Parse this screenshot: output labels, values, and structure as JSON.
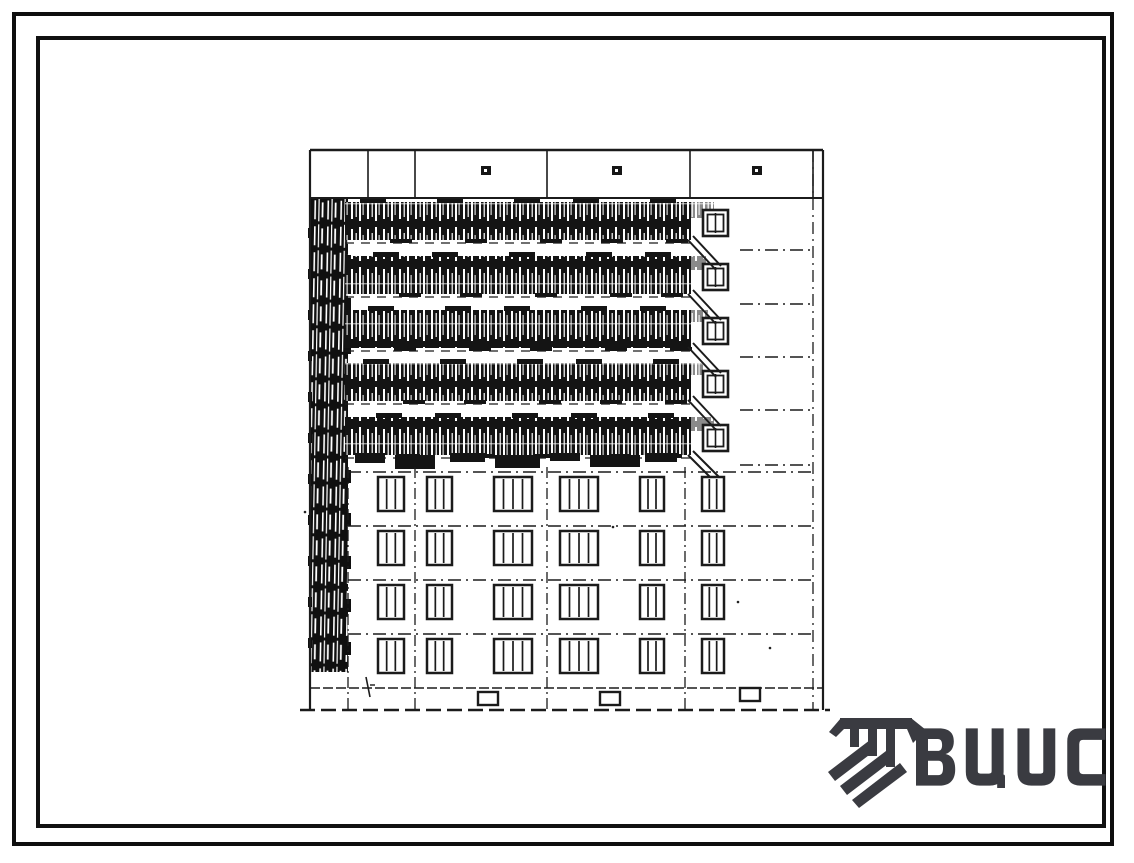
{
  "document": {
    "description": "Scanned facade elevation of a 9-storey panel apartment block: five upper floors with dark hatched balcony bands, four lower floors with window grid, parapet band and basement"
  },
  "branding": {
    "logo_text": "ВЦИС",
    "logo_icon": "hatched-monogram-icon",
    "logo_color": "#3a3b41"
  },
  "frame": {
    "background": "#ffffff",
    "outer_border_color": "#0e0e0e",
    "inner_border_color": "#111111"
  },
  "elevation": {
    "ink": "#1b1b1b",
    "band_fill": "#141414",
    "counts": {
      "balcony_floors": 5,
      "window_floors": 4,
      "windows_per_floor": 6,
      "loggia_windows": 5,
      "parapet_vents": 3,
      "basement_vents": 3
    },
    "geometry": {
      "width": 540,
      "height": 570,
      "outline": {
        "left": 10,
        "right": 523,
        "inner_right": 513,
        "top": 5,
        "ground": 565
      },
      "parapet": {
        "top": 5,
        "bottom": 53,
        "joints": [
          68,
          115,
          247,
          390,
          513
        ],
        "marks": {
          "y": 21,
          "w": 10,
          "h": 9,
          "xs": [
            181,
            312,
            452
          ]
        }
      },
      "stair_strip": {
        "x": 10,
        "w": 38,
        "top": 53,
        "bottom": 527
      },
      "balcony": {
        "x": 45,
        "w": 346,
        "h": 38,
        "tops": [
          57,
          111,
          165,
          218,
          272
        ]
      },
      "spill": [
        [
          390,
          57,
          24,
          16
        ],
        [
          390,
          111,
          16,
          14
        ],
        [
          390,
          165,
          18,
          12
        ],
        [
          390,
          218,
          14,
          12
        ],
        [
          390,
          272,
          24,
          14
        ]
      ],
      "scallops": [
        [
          55,
          308,
          30,
          10
        ],
        [
          95,
          310,
          40,
          14
        ],
        [
          150,
          308,
          35,
          9
        ],
        [
          195,
          310,
          45,
          13
        ],
        [
          250,
          308,
          30,
          8
        ],
        [
          290,
          310,
          50,
          12
        ],
        [
          345,
          308,
          32,
          9
        ]
      ],
      "loggia_win": {
        "x": 403,
        "w": 25,
        "h": 26,
        "tops": [
          65,
          119,
          173,
          226,
          280
        ]
      },
      "diag": {
        "x1": 388,
        "x2": 416,
        "pairs": [
          [
            95,
            125
          ],
          [
            149,
            179
          ],
          [
            202,
            232
          ],
          [
            255,
            285
          ],
          [
            310,
            338
          ]
        ]
      },
      "upper_dash": {
        "x1": 440,
        "x2": 513,
        "ys": [
          105,
          159,
          212,
          265,
          320
        ]
      },
      "lower_joints": {
        "xs": [
          48,
          115,
          247,
          385
        ],
        "top": 322,
        "bottom": 565
      },
      "floor_dash": {
        "x1": 48,
        "x2": 513,
        "ys": [
          327,
          381,
          435,
          489
        ]
      },
      "windows": {
        "h": 34,
        "tops": [
          332,
          386,
          440,
          494
        ],
        "cols": [
          {
            "x": 78,
            "w": 26,
            "m": 2
          },
          {
            "x": 127,
            "w": 25,
            "m": 2
          },
          {
            "x": 194,
            "w": 38,
            "m": 3
          },
          {
            "x": 260,
            "w": 38,
            "m": 3
          },
          {
            "x": 340,
            "w": 24,
            "m": 2
          },
          {
            "x": 402,
            "w": 22,
            "m": 2
          }
        ]
      },
      "basement": {
        "line_y": 543,
        "vents": {
          "y": 547,
          "w": 20,
          "h": 13,
          "xs": [
            178,
            300,
            440
          ]
        }
      },
      "specks": [
        [
          5,
          367
        ],
        [
          313,
          382
        ],
        [
          438,
          457
        ],
        [
          470,
          503
        ]
      ]
    }
  }
}
